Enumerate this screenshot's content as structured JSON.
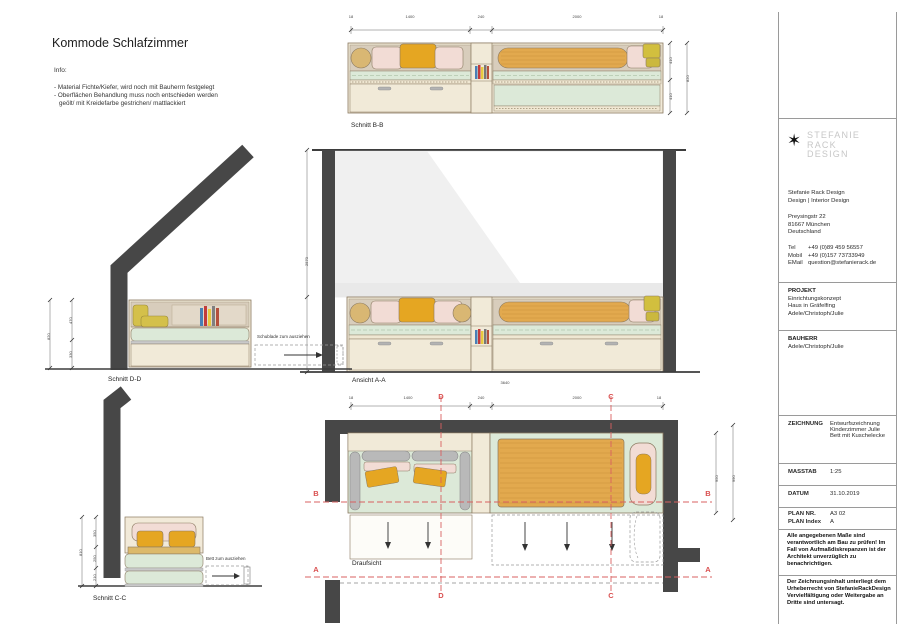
{
  "title": "Kommode Schlafzimmer",
  "info": {
    "heading": "Info:",
    "line1": "- Material Fichte/Kiefer, wird noch mit Bauherrn festgelegt",
    "line2": "- Oberflächen Behandlung muss noch entschieden werden",
    "line3": "geölt/ mit Kreidefarbe gestrichen/ mattlackiert"
  },
  "views": {
    "schnitt_bb": {
      "label": "Schnitt B-B",
      "dims_top": [
        "18",
        "1400",
        "240",
        "2000",
        "18"
      ],
      "dims_right": [
        "410",
        "410",
        "820"
      ]
    },
    "ansicht_aa": {
      "label": "Ansicht A-A",
      "dim_total": "3640",
      "dim_height": "2570"
    },
    "schnitt_dd": {
      "label": "Schnitt D-D",
      "annotation": "Schublade zum ausziehen",
      "dims_left": [
        "470",
        "330",
        "820"
      ]
    },
    "schnitt_cc": {
      "label": "Schnitt C-C",
      "annotation": "Bett zum ausziehen",
      "dims_left": [
        "350",
        "250",
        "210",
        "810"
      ]
    },
    "draufsicht": {
      "label": "Draufsicht",
      "dims_top": [
        "18",
        "1400",
        "240",
        "2000",
        "18"
      ],
      "dims_right": [
        "950",
        "990"
      ],
      "letters": {
        "a": "A",
        "b": "B",
        "c": "C",
        "d": "D"
      }
    }
  },
  "titleblock": {
    "logo": {
      "star": "✶",
      "line1": "Stefanie",
      "line2": "Rack",
      "line3": "Design"
    },
    "studio": {
      "name": "Stefanie Rack Design",
      "subtitle": "Design | Interior Design",
      "address1": "Preysingstr 22",
      "address2": "81667 München",
      "address3": "Deutschland",
      "tel_label": "Tel",
      "tel": "+49 (0)89 459 56557",
      "mobil_label": "Mobil",
      "mobil": "+49 (0)157 73733949",
      "email_label": "EMail",
      "email": "question@stefanierack.de"
    },
    "projekt": {
      "label": "PROJEKT",
      "line1": "Einrichtungskonzept",
      "line2": "Haus in Gräfelfing",
      "line3": "Adele/Christoph/Julie"
    },
    "bauherr": {
      "label": "BAUHERR",
      "line1": "Adele/Christoph/Julie"
    },
    "zeichnung": {
      "label": "ZEICHNUNG",
      "line1": "Entwurfszeichnung",
      "line2": "Kinderzimmer Julie",
      "line3": "Bett mit Kuschelecke"
    },
    "masstab": {
      "label": "MASSTAB",
      "value": "1:25"
    },
    "datum": {
      "label": "DATUM",
      "value": "31.10.2019"
    },
    "plan_nr": {
      "label": "PLAN NR.",
      "value": "A3 02"
    },
    "plan_index": {
      "label": "PLAN Index",
      "value": "A"
    },
    "note1": "Alle angegebenen Maße sind verantwortlich am Bau zu prüfen! Im Fall von Aufmaßdiskrepanzen ist der Architekt unverzüglich zu benachrichtigen.",
    "note2": "Der Zeichnungsinhalt unterliegt dem Urheberrecht von StefanieRackDesign Vervielfältigung oder Weitergabe an Dritte sind untersagt."
  },
  "colors": {
    "wall": "#474747",
    "wood": "#f1ead8",
    "wood_dark": "#d8cdbc",
    "mattress": "#dce9d8",
    "pillow_pink": "#f2dcd5",
    "cushion_orange": "#e5a622",
    "cushion_yellow": "#d4c04a",
    "bolster_tan": "#d9b773",
    "blanket_orange": "#e2a94e",
    "section_red": "#d94f4f"
  }
}
